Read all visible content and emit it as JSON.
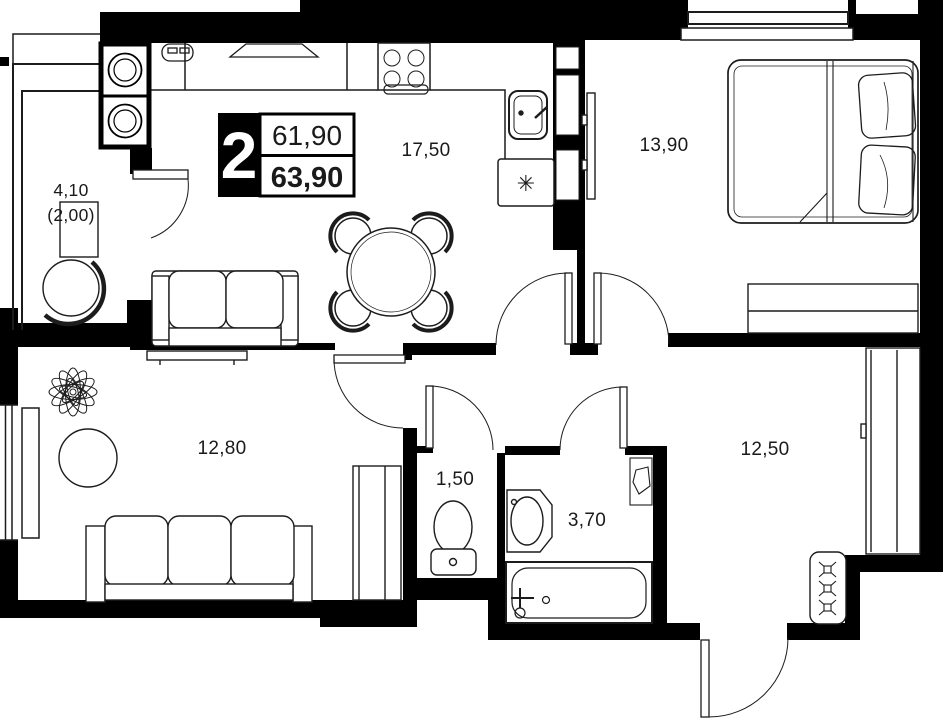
{
  "floorplan": {
    "badge": {
      "rooms_count": "2",
      "living_area": "61,90",
      "total_area": "63,90"
    },
    "labels": {
      "balcony_area": "4,10",
      "balcony_area_reduced": "(2,00)",
      "kitchen_living_area": "17,50",
      "bedroom_area": "13,90",
      "living_room_area": "12,80",
      "hallway_area": "12,50",
      "wc_area": "1,50",
      "bathroom_area": "3,70"
    },
    "symbols": {
      "dishwasher_asterisk": "✳"
    },
    "colors": {
      "walls": "#000000",
      "outline": "#1c1c1c",
      "background": "#ffffff",
      "text": "#1a1a1a",
      "badge_bg": "#000000",
      "badge_text": "#ffffff"
    }
  }
}
